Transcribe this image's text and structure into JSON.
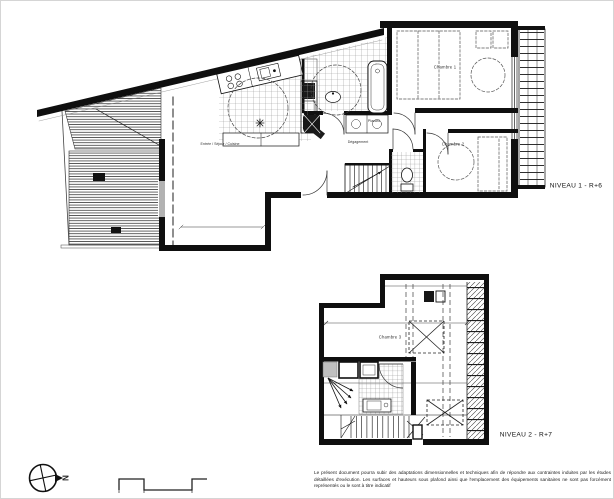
{
  "levels": [
    {
      "label": "NIVEAU 1 - R+6",
      "rooms": [
        {
          "label": "Entrée / Séjour / Cuisine"
        },
        {
          "label": "Chambre 1"
        },
        {
          "label": "Chambre 2"
        },
        {
          "label": "Dégagement"
        },
        {
          "label": "Placard"
        }
      ]
    },
    {
      "label": "NIVEAU 2 - R+7",
      "rooms": [
        {
          "label": "Chambre 3"
        }
      ]
    }
  ],
  "compass": {
    "north_label": "N"
  },
  "footer": {
    "disclaimer": "Le présent document pourra subir des adaptations dimensionnelles et techniques afin de répondre aux contraintes induites par les études détaillées d'exécution. Les surfaces et hauteurs sous plafond ainsi que l'emplacement des équipements sanitaires ne sont pas forcément représentés ou le sont à titre indicatif"
  },
  "colors": {
    "ink": "#111111",
    "wall": "#0f0f0f",
    "hatch": "#444444",
    "tile": "#9a9a9a",
    "background": "#ffffff"
  }
}
